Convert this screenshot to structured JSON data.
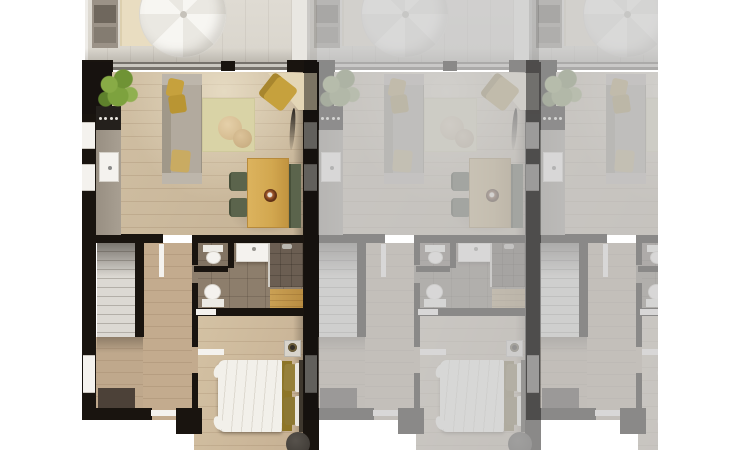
{
  "scene": {
    "label": "Rendered ground-floor plan of three terraced apartment units; left end unit highlighted in full colour, two adjacent units faded",
    "canvas": {
      "width": 730,
      "height": 450
    }
  },
  "units": [
    {
      "id": "unit-1",
      "label": "Highlighted apartment unit floor plan",
      "state": "highlighted"
    },
    {
      "id": "unit-2",
      "label": "Adjacent apartment unit, faded",
      "state": "faded"
    },
    {
      "id": "unit-3",
      "label": "Adjacent apartment unit, faded and cropped at right edge",
      "state": "faded"
    }
  ],
  "rooms": [
    "terrace",
    "living-room",
    "kitchen",
    "dining-area",
    "hallway",
    "staircase",
    "entry",
    "bathroom",
    "wc",
    "shower",
    "bedroom"
  ],
  "furniture": [
    "parasol",
    "lounger",
    "barbecue",
    "potted-plant",
    "sofa",
    "sofa-cushions",
    "rug",
    "poufs",
    "armchair",
    "corner-desk",
    "wall-tv",
    "dining-table",
    "dining-chairs",
    "dining-bench",
    "fruit-bowl",
    "kitchen-counter",
    "cooktop",
    "kitchen-sink",
    "toilet",
    "washbasin",
    "shower-head",
    "wooden-bench",
    "double-bed",
    "pillows",
    "nightstand",
    "lamp",
    "stool",
    "doormat",
    "stairs"
  ],
  "colors": {
    "wall": "#19140f",
    "wood": "#d1c0a4",
    "wood2": "#c3ab8e",
    "patio": "#dfdbd3",
    "divider": "#e9e7e2",
    "tile": "#8d7e6c",
    "tiledark": "#6b5e52",
    "counter": "#a89f92",
    "yellow": "#c6a13d",
    "green": "#7da23e",
    "olive": "#5b644c",
    "woodfurn": "#d2a74f",
    "sofa": "#b2aa9e",
    "fixture": "#f4f2ee",
    "rug": "#d9d3a6",
    "mat": "#4c4138",
    "duvet": "#f2f0ea",
    "runner": "#8d7527",
    "background": "#ffffff"
  }
}
